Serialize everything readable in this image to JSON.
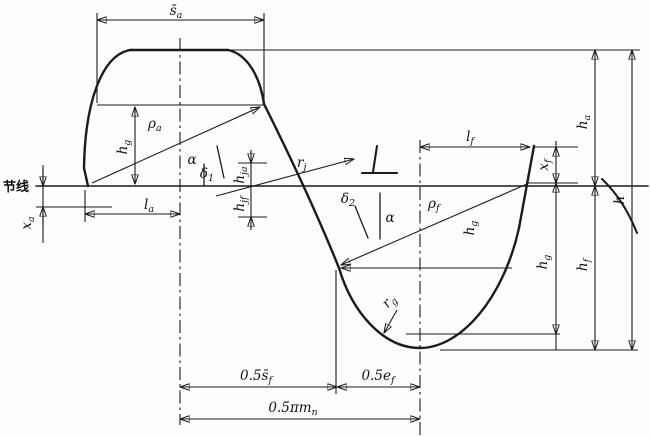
{
  "figure": {
    "description": "Gear rack / hob tooth profile dimensioning diagram",
    "ink_color": "#1b1b1b",
    "background": "#fdfdfc",
    "pitch_line": {
      "label": "节线"
    },
    "labels": {
      "sa": {
        "text": "s̄",
        "sub": "a"
      },
      "hg_top": {
        "text": "h",
        "sub": "g"
      },
      "rho_a": {
        "text": "ρ",
        "sub": "a"
      },
      "alpha_top": {
        "text": "α"
      },
      "delta_1": {
        "text": "δ",
        "sub": "1"
      },
      "r_j": {
        "text": "r",
        "sub": "j"
      },
      "h_ja": {
        "text": "h",
        "sub": "ja"
      },
      "h_jf": {
        "text": "h",
        "sub": "jf"
      },
      "l_a": {
        "text": "l",
        "sub": "a"
      },
      "x_a": {
        "text": "x",
        "sub": "a"
      },
      "delta_2": {
        "text": "δ",
        "sub": "2"
      },
      "alpha_bot": {
        "text": "α"
      },
      "rho_f": {
        "text": "ρ",
        "sub": "f"
      },
      "hg_bottom": {
        "text": "h",
        "sub": "g"
      },
      "r_g": {
        "text": "r",
        "sub": "g"
      },
      "l_f": {
        "text": "l",
        "sub": "f"
      },
      "x_f": {
        "text": "x",
        "sub": "f"
      },
      "h_a": {
        "text": "h",
        "sub": "a"
      },
      "hg_right": {
        "text": "h",
        "sub": "g"
      },
      "h_f": {
        "text": "h",
        "sub": "f"
      },
      "h": {
        "text": "h"
      },
      "half_sf": {
        "text": "0.5s̄",
        "sub": "f"
      },
      "half_ef": {
        "text": "0.5e",
        "sub": "f"
      },
      "half_pimn": {
        "text": "0.5πm",
        "sub": "n"
      }
    }
  }
}
